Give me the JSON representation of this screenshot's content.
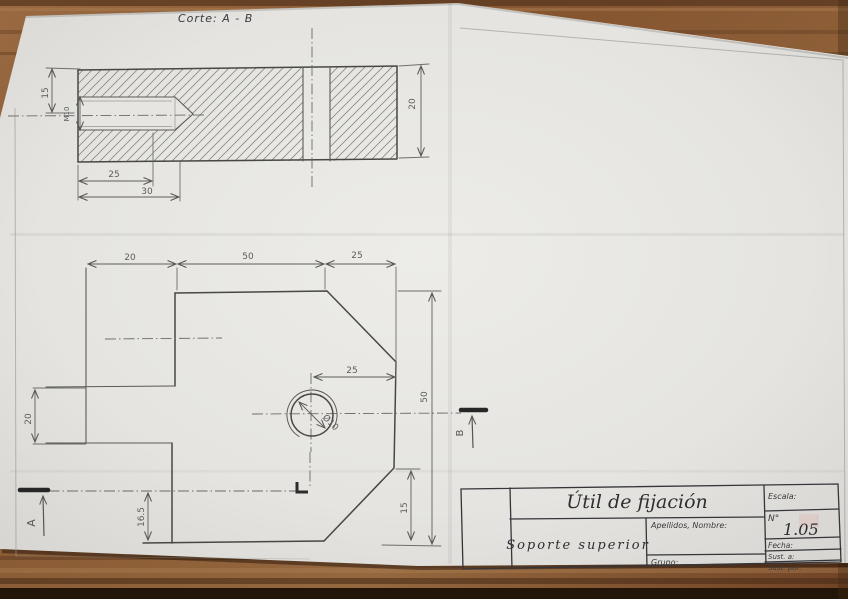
{
  "drawing": {
    "section_label": "Corte:  A - B",
    "section_view": {
      "dim_thickness": "15",
      "dim_thread": "M10",
      "dim_thread_depth": "25",
      "dim_drill_depth": "30",
      "dim_height": "20"
    },
    "plan_view": {
      "dim_top_left": "20",
      "dim_top_mid": "50",
      "dim_top_right": "25",
      "dim_tab_height": "20",
      "dim_hole_to_edge": "25",
      "dim_bottom_offset": "16.5",
      "dim_chamfer_height": "15",
      "dim_total_height": "50",
      "dim_hole_dia": "Ø10",
      "marker_a": "A",
      "marker_b": "B"
    },
    "title_block": {
      "title": "Útil de fijación",
      "part_name": "Soporte superior",
      "names_label": "Apellidos, Nombre:",
      "group_label": "Grupo:",
      "scale_label": "Escala:",
      "number_label": "N°",
      "number_value": "1.05",
      "date_label": "Fecha:",
      "replaces_label": "Sust. a:",
      "replaced_by_label": "Sust. por:"
    },
    "colors": {
      "paper": "#e9e8e4",
      "wood": "#8a5a38",
      "pencil": "#4a4a48"
    }
  }
}
